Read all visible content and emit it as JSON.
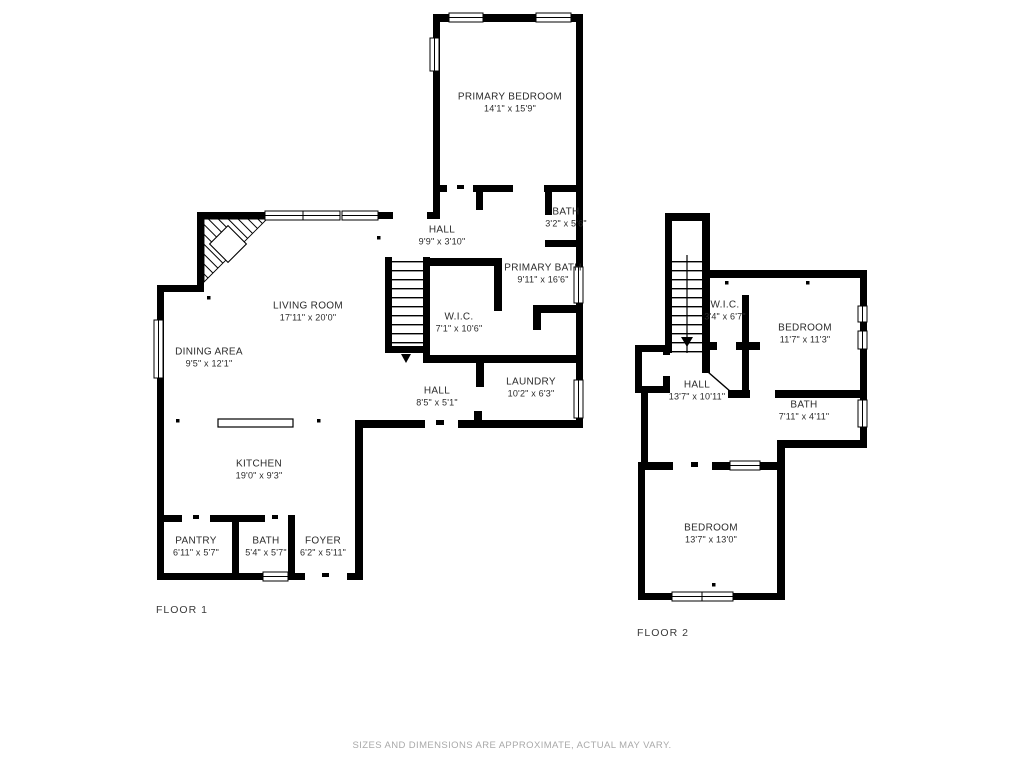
{
  "page": {
    "footer_disclaimer": "SIZES AND DIMENSIONS ARE APPROXIMATE, ACTUAL MAY VARY."
  },
  "floor1": {
    "label": "FLOOR 1",
    "rooms": [
      {
        "name": "PRIMARY BEDROOM",
        "dims": "14'1\" x 15'9\""
      },
      {
        "name": "BATH",
        "dims": "3'2\" x 5'6\""
      },
      {
        "name": "HALL",
        "dims": "9'9\" x 3'10\""
      },
      {
        "name": "PRIMARY BATH",
        "dims": "9'11\" x 16'6\""
      },
      {
        "name": "W.I.C.",
        "dims": "7'1\" x 10'6\""
      },
      {
        "name": "LIVING ROOM",
        "dims": "17'11\" x 20'0\""
      },
      {
        "name": "DINING AREA",
        "dims": "9'5\" x 12'1\""
      },
      {
        "name": "HALL",
        "dims": "8'5\" x 5'1\""
      },
      {
        "name": "LAUNDRY",
        "dims": "10'2\" x 6'3\""
      },
      {
        "name": "KITCHEN",
        "dims": "19'0\" x 9'3\""
      },
      {
        "name": "PANTRY",
        "dims": "6'11\" x 5'7\""
      },
      {
        "name": "BATH",
        "dims": "5'4\" x 5'7\""
      },
      {
        "name": "FOYER",
        "dims": "6'2\" x 5'11\""
      }
    ]
  },
  "floor2": {
    "label": "FLOOR 2",
    "rooms": [
      {
        "name": "W.I.C.",
        "dims": "3'4\" x 6'7\""
      },
      {
        "name": "BEDROOM",
        "dims": "11'7\" x 11'3\""
      },
      {
        "name": "HALL",
        "dims": "13'7\" x 10'11\""
      },
      {
        "name": "BATH",
        "dims": "7'11\" x 4'11\""
      },
      {
        "name": "BEDROOM",
        "dims": "13'7\" x 13'0\""
      }
    ]
  },
  "colors": {
    "wall": "#000000",
    "background": "#ffffff",
    "label_text": "#2b2b2b",
    "footer_text": "#a9a9a9"
  }
}
